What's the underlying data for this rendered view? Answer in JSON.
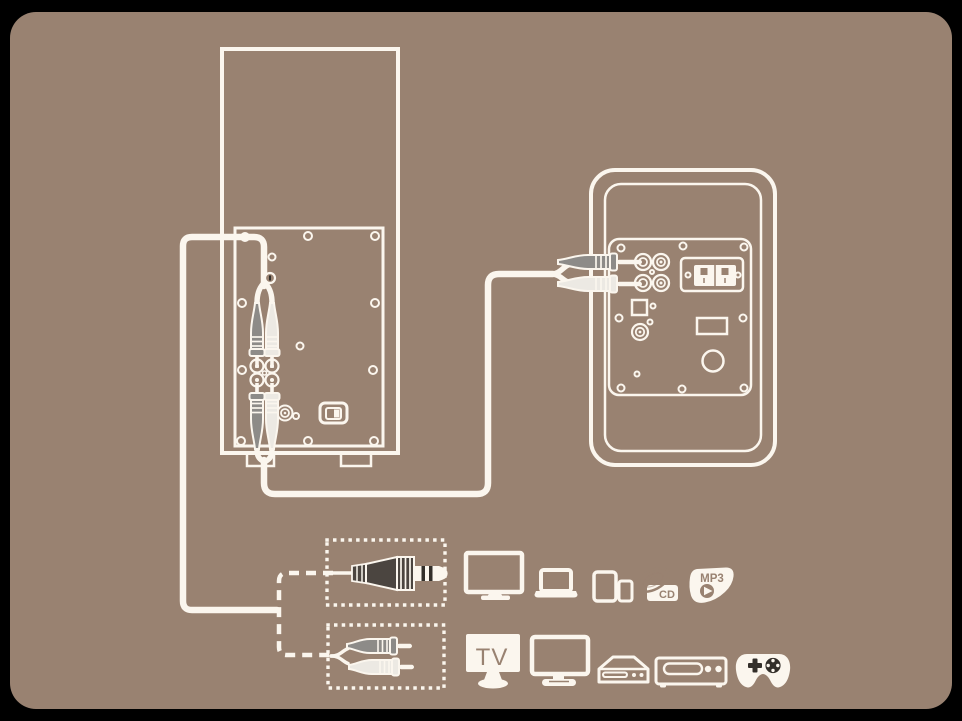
{
  "colors": {
    "canvas": "#000000",
    "bg": "#998271",
    "line": "#fbf6ee",
    "plug_gray": "#8d8b88",
    "plug_light": "#ece9e3",
    "plug_dark": "#4b4540",
    "icon_dark": "#332f2a"
  },
  "labels": {
    "tv": "TV",
    "cd": "CD",
    "mp3": "MP3"
  },
  "diagram": {
    "type": "speaker-connection-diagram",
    "left_device": "subwoofer-rear-view",
    "right_device": "satellite-speaker-rear-view",
    "cable_options": [
      "3.5mm-aux-cable",
      "rca-cable"
    ],
    "source_icons_row1": [
      "desktop-monitor",
      "laptop",
      "tablet-and-phone",
      "cd-player",
      "mp3-player"
    ],
    "source_icons_row2": [
      "tv",
      "desktop-monitor",
      "set-top-box",
      "dvd-player",
      "game-controller"
    ]
  }
}
